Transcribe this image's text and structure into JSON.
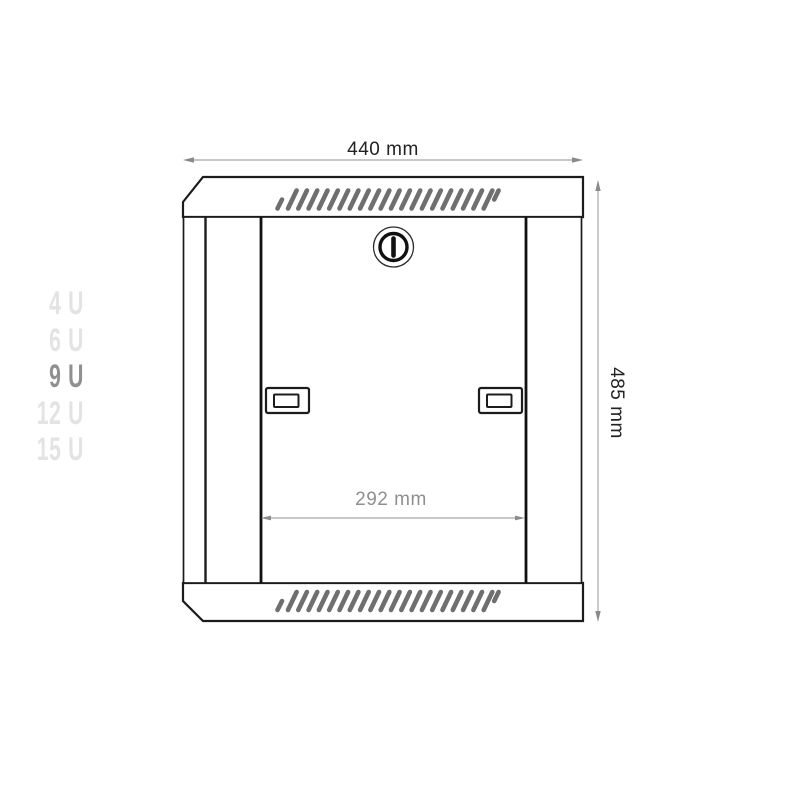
{
  "unit_selector": {
    "options": [
      {
        "label": "4 U",
        "selected": false
      },
      {
        "label": "6 U",
        "selected": false
      },
      {
        "label": "9 U",
        "selected": true
      },
      {
        "label": "12 U",
        "selected": false
      },
      {
        "label": "15 U",
        "selected": false
      }
    ],
    "selected_color": "#909090",
    "unselected_color": "#e3e3e3"
  },
  "dimensions": {
    "width_label": "440 mm",
    "height_label": "485 mm",
    "inner_width_label": "292 mm"
  },
  "drawing": {
    "colors": {
      "outline": "#1c1c1c",
      "vent_slats": "#6f6f6f",
      "dimension_line": "#b5b5b5",
      "dimension_arrowhead": "#8a8a8a",
      "outer_dimension_text": "#222222",
      "inner_dimension_text": "#8f8f8f"
    }
  }
}
